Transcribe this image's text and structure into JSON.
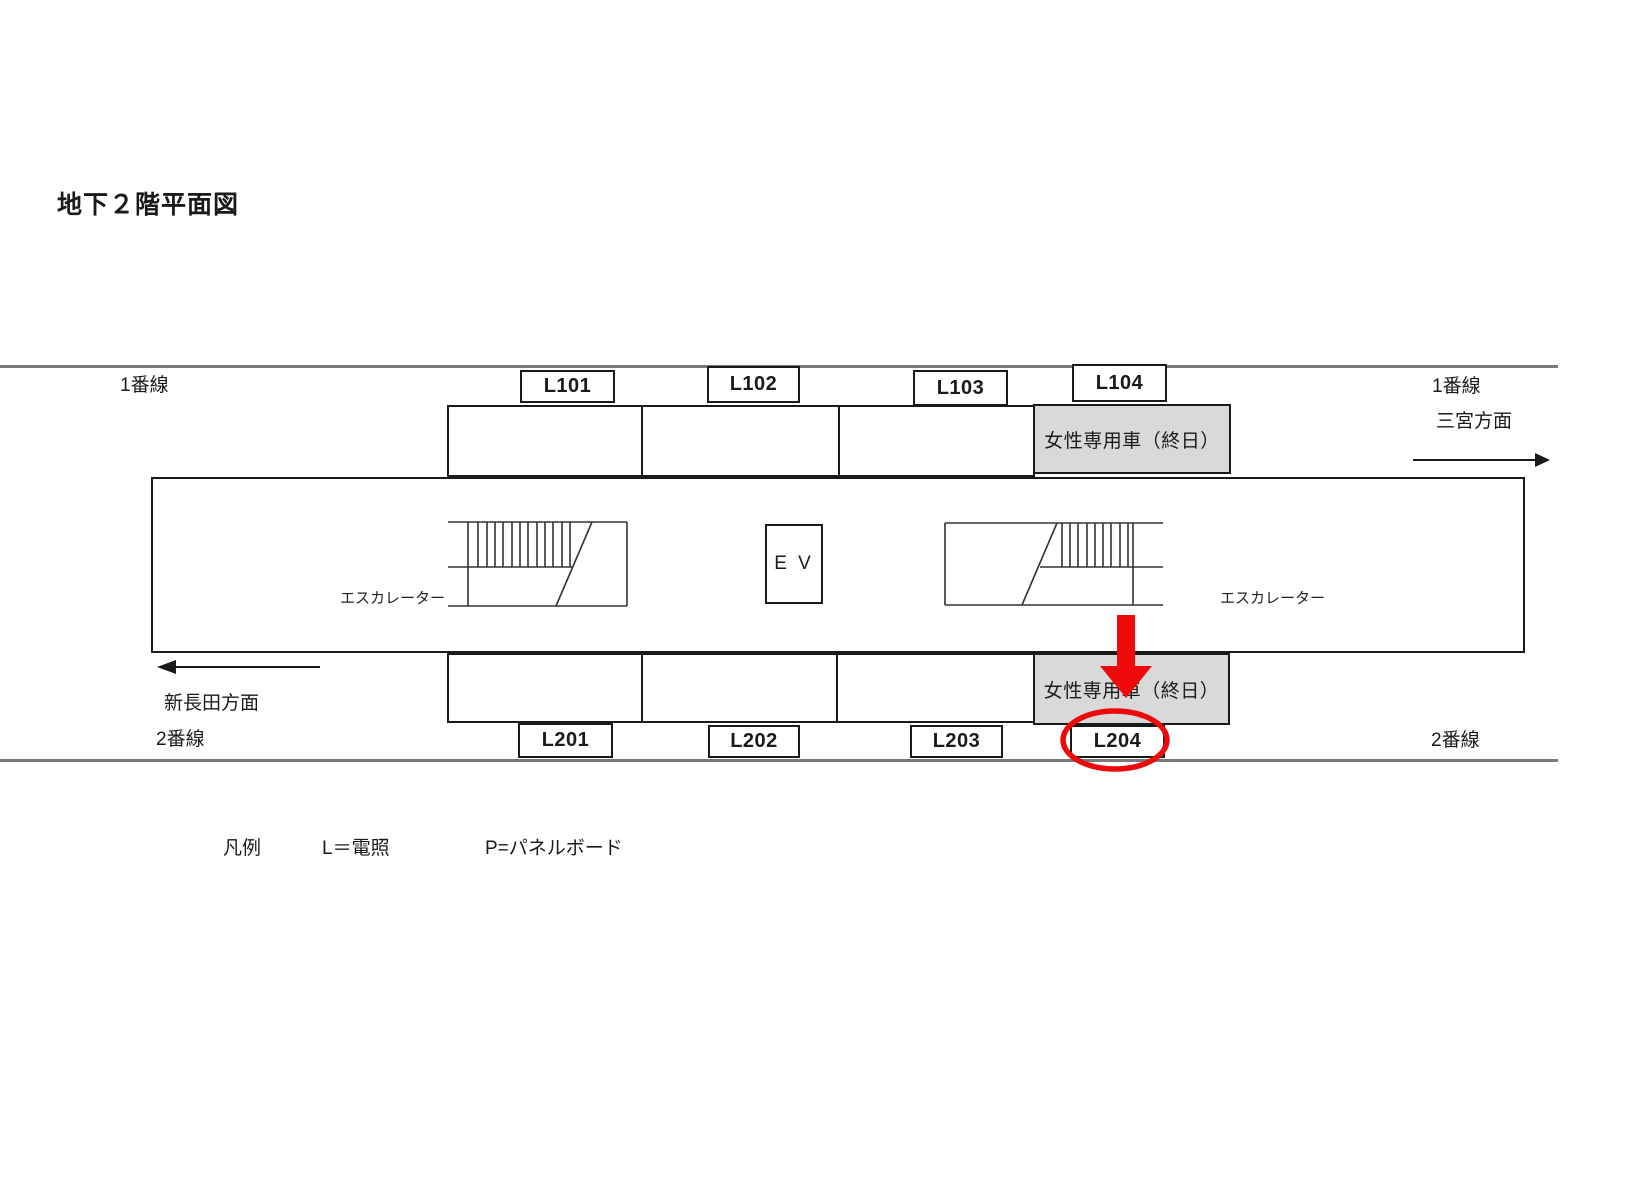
{
  "title": "地下２階平面図",
  "tracks": {
    "top_left": "1番線",
    "top_right": "1番線",
    "direction_right": "三宮方面",
    "direction_left": "新長田方面",
    "bottom_left": "2番線",
    "bottom_right": "2番線"
  },
  "cars": {
    "womens_car_top": "女性専用車（終日）",
    "womens_car_bottom": "女性専用車（終日）"
  },
  "signs": {
    "top": [
      "L101",
      "L102",
      "L103",
      "L104"
    ],
    "bottom": [
      "L201",
      "L202",
      "L203",
      "L204"
    ]
  },
  "platform": {
    "elevator": "E V",
    "escalator_left": "エスカレーター",
    "escalator_right": "エスカレーター"
  },
  "legend": {
    "heading": "凡例",
    "item_l": "L＝電照",
    "item_p": "P=パネルボード"
  },
  "annotation": {
    "highlighted_sign": "L204"
  },
  "colors": {
    "annotation_red": "#ee0a0a",
    "womens_car_bg": "#d9d9d9",
    "track_gray": "#7a7a7a",
    "ink": "#1a1a1a"
  }
}
